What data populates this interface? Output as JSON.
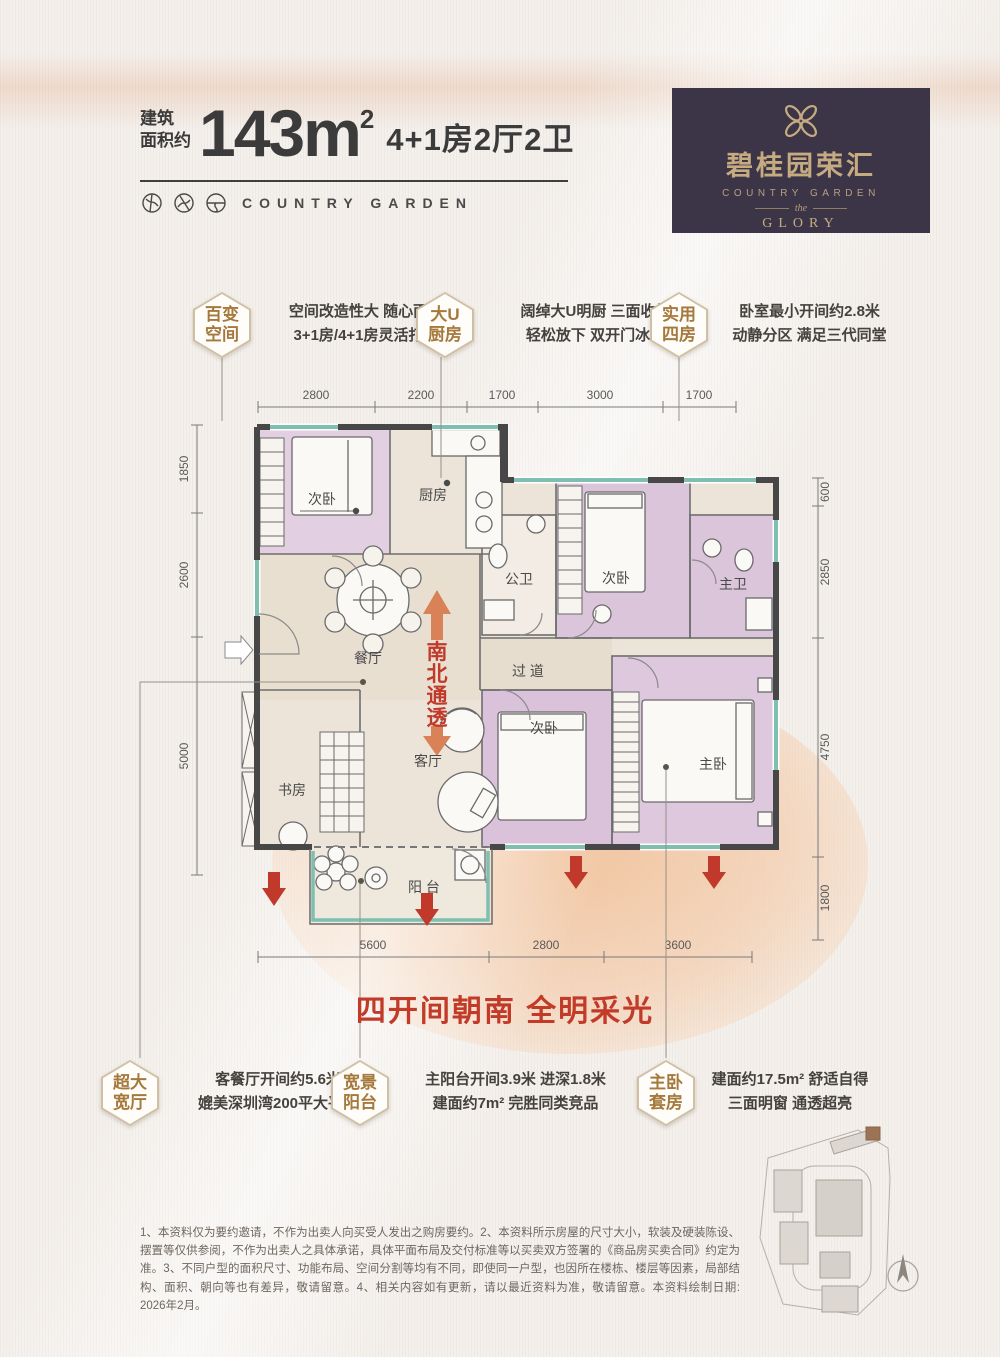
{
  "header": {
    "area_label_line1": "建筑",
    "area_label_line2": "面积约",
    "area_value": "143m",
    "area_sup": "2",
    "layout": "4+1房2厅2卫",
    "brand_en": "COUNTRY GARDEN"
  },
  "logo": {
    "name_cn": "碧桂园荣汇",
    "name_en": "COUNTRY GARDEN",
    "the": "the",
    "glory": "GLORY"
  },
  "features_top": [
    {
      "title_line1": "百变",
      "title_line2": "空间",
      "desc_line1": "空间改造性大 随心而变",
      "desc_line2": "3+1房/4+1房灵活打造"
    },
    {
      "title_line1": "大U",
      "title_line2": "厨房",
      "desc_line1": "阔绰大U明厨 三面收纳",
      "desc_line2": "轻松放下 双开门冰箱"
    },
    {
      "title_line1": "实用",
      "title_line2": "四房",
      "desc_line1": "卧室最小开间约2.8米",
      "desc_line2": "动静分区 满足三代同堂"
    }
  ],
  "features_bottom": [
    {
      "title_line1": "超大",
      "title_line2": "宽厅",
      "desc_line1": "客餐厅开间约5.6米",
      "desc_line2": "媲美深圳湾200平大平层"
    },
    {
      "title_line1": "宽景",
      "title_line2": "阳台",
      "desc_line1": "主阳台开间3.9米 进深1.8米",
      "desc_line2": "建面约7m² 完胜同类竞品"
    },
    {
      "title_line1": "主卧",
      "title_line2": "套房",
      "desc_line1": "建面约17.5m² 舒适自得",
      "desc_line2": "三面明窗 通透超亮"
    }
  ],
  "floorplan": {
    "rooms": {
      "bed1": "次卧",
      "kitchen": "厨房",
      "pub_bath": "公卫",
      "bed2": "次卧",
      "master_bath": "主卫",
      "dining": "餐厅",
      "hallway": "过 道",
      "living": "客厅",
      "study": "书房",
      "bed3": "次卧",
      "master": "主卧",
      "balcony": "阳 台"
    },
    "orientation": [
      "南",
      "北",
      "通",
      "透"
    ],
    "dims_top": [
      "2800",
      "2200",
      "1700",
      "3000",
      "1700"
    ],
    "dims_left": [
      "1850",
      "2600",
      "5000"
    ],
    "dims_right": [
      "600",
      "2850",
      "4750",
      "1800"
    ],
    "dims_bottom": [
      "5600",
      "2800",
      "3600"
    ]
  },
  "banner": "四开间朝南 全明采光",
  "disclaimer": "1、本资料仅为要约邀请，不作为出卖人向买受人发出之购房要约。2、本资料所示房屋的尺寸大小，软装及硬装陈设、摆置等仅供参阅，不作为出卖人之具体承诺，具体平面布局及交付标准等以买卖双方签署的《商品房买卖合同》约定为准。3、不同户型的面积尺寸、功能布局、空间分割等均有不同，即使同一户型，也因所在楼栋、楼层等因素，局部结构、面积、朝向等也有差异，敬请留意。4、相关内容如有更新，请以最近资料为准，敬请留意。本资料绘制日期: 2026年2月。",
  "colors": {
    "accent_red": "#c0392b",
    "badge_gold": "#a5793c",
    "logo_bg": "#3c3547",
    "logo_gold": "#c6ab81",
    "room_pink": "#dcc6dc",
    "window_teal": "#7fbfb0"
  }
}
